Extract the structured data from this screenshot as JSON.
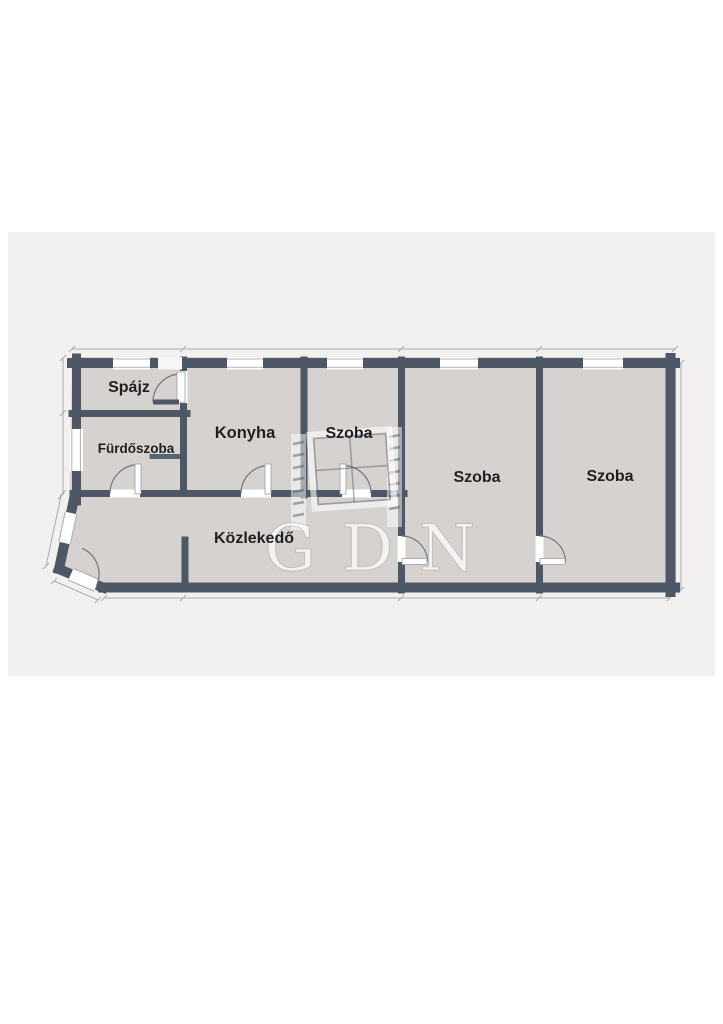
{
  "page": {
    "background_color": "#ffffff",
    "canvas_background_color": "#f2f1ef"
  },
  "floor_plan": {
    "wall_color": "#4d5765",
    "floor_color": "#d6d2cf",
    "dimension_line_color": "#9aa0a8",
    "rooms": [
      {
        "id": "spajz",
        "label": "Spájz"
      },
      {
        "id": "furdoszoba",
        "label": "Fürdőszoba"
      },
      {
        "id": "konyha",
        "label": "Konyha"
      },
      {
        "id": "szoba-1",
        "label": "Szoba"
      },
      {
        "id": "szoba-2",
        "label": "Szoba"
      },
      {
        "id": "szoba-3",
        "label": "Szoba"
      },
      {
        "id": "kozlekedo",
        "label": "Közlekedő"
      }
    ],
    "watermark": {
      "text": "GDN"
    }
  }
}
